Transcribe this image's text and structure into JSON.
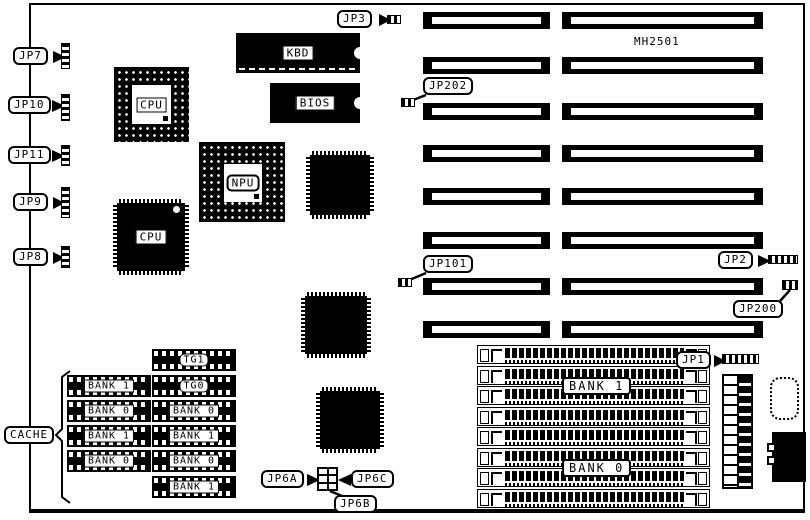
{
  "board": {
    "model": "MH2501"
  },
  "chips": {
    "cpu_socket": "CPU",
    "cpu_qfp": "CPU",
    "npu": "NPU",
    "kbd": "KBD",
    "bios": "BIOS"
  },
  "jumpers": {
    "jp1": "JP1",
    "jp2": "JP2",
    "jp3": "JP3",
    "jp6a": "JP6A",
    "jp6b": "JP6B",
    "jp6c": "JP6C",
    "jp7": "JP7",
    "jp8": "JP8",
    "jp9": "JP9",
    "jp10": "JP10",
    "jp11": "JP11",
    "jp101": "JP101",
    "jp200": "JP200",
    "jp202": "JP202"
  },
  "cache": {
    "label": "CACHE",
    "left_column": [
      "BANK 1",
      "BANK 0",
      "BANK 1",
      "BANK 0"
    ],
    "right_column": [
      "TG1",
      "TG0",
      "BANK 0",
      "BANK 1",
      "BANK 0",
      "BANK 1"
    ]
  },
  "memory": {
    "bank1": "BANK 1",
    "bank0": "BANK 0"
  },
  "colors": {
    "ink": "#000000",
    "paper": "#ffffff"
  }
}
